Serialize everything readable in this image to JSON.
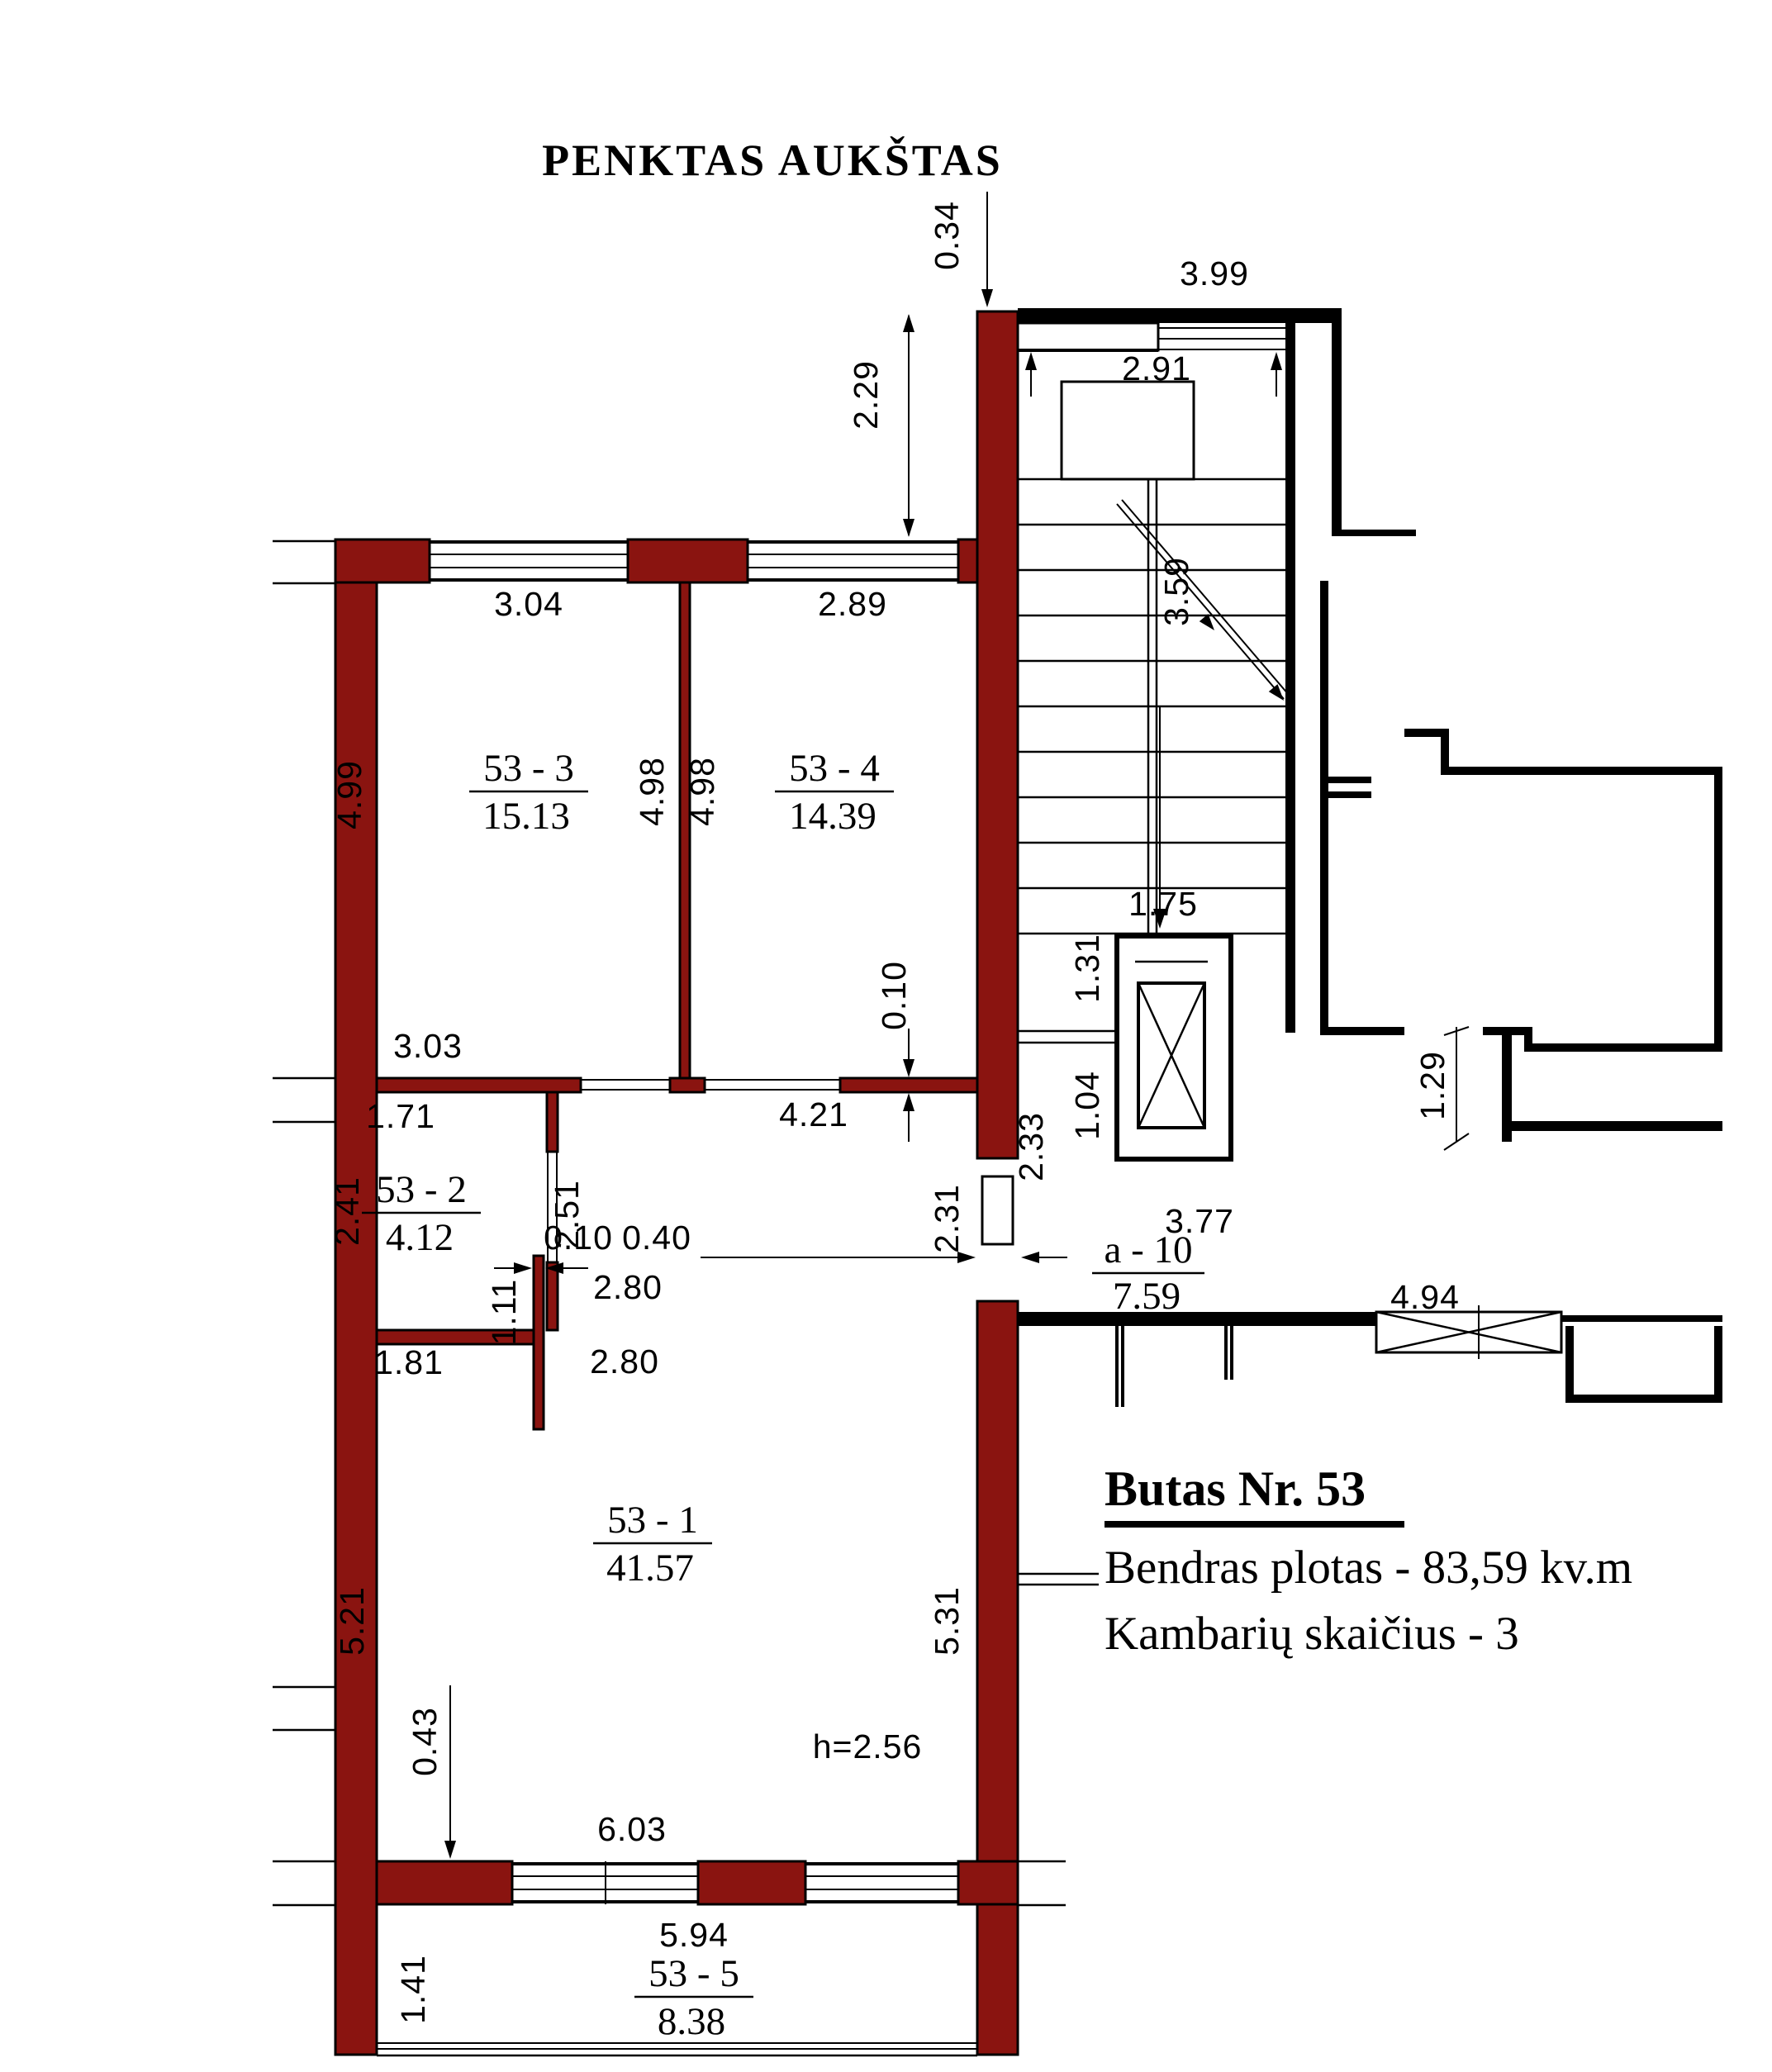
{
  "title": "PENKTAS AUKŠTAS",
  "colors": {
    "wall": "#8a1410",
    "line": "#000000",
    "bg": "#ffffff"
  },
  "info": {
    "heading": "Butas Nr. 53",
    "total_area": "Bendras plotas - 83,59 kv.m",
    "rooms_count": "Kambarių skaičius - 3"
  },
  "rooms": {
    "r1": {
      "name": "53 - 1",
      "area": "41.57"
    },
    "r2": {
      "name": "53 - 2",
      "area": "4.12"
    },
    "r3": {
      "name": "53 - 3",
      "area": "15.13"
    },
    "r4": {
      "name": "53 - 4",
      "area": "14.39"
    },
    "r5": {
      "name": "53 - 5",
      "area": "8.38"
    },
    "a10": {
      "name": "a - 10",
      "area": "7.59"
    }
  },
  "dims": {
    "top_0_34": "0.34",
    "top_3_99": "3.99",
    "stair_2_91": "2.91",
    "wall_2_29": "2.29",
    "stair_run_3_59": "3.59",
    "r3_w": "3.04",
    "r4_w": "2.89",
    "r3_h": "4.99",
    "r3_h2": "4.98",
    "r4_h": "4.98",
    "elev_1_75": "1.75",
    "elev_1_31": "1.31",
    "elev_1_04": "1.04",
    "lobby_3_77": "3.77",
    "lobby_4_94": "4.94",
    "pass_1_29": "1.29",
    "r3_b": "3.03",
    "r2_w": "1.71",
    "hall_4_21": "4.21",
    "thick_0_10_wall": "0.10",
    "thick_0_10_stub": "0.10",
    "r2_h": "2.41",
    "r2_d": "2.51",
    "r2_b": "1.81",
    "stub_1_11": "1.11",
    "hall_2_80a": "2.80",
    "hall_2_80b": "2.80",
    "wall_0_40": "0.40",
    "door_2_31": "2.31",
    "door_2_33": "2.33",
    "r1_hl": "5.21",
    "r1_hr": "5.31",
    "r1_0_43": "0.43",
    "r1_w": "6.03",
    "ceiling_h": "h=2.56",
    "r5_w": "5.94",
    "r5_d": "1.41"
  }
}
